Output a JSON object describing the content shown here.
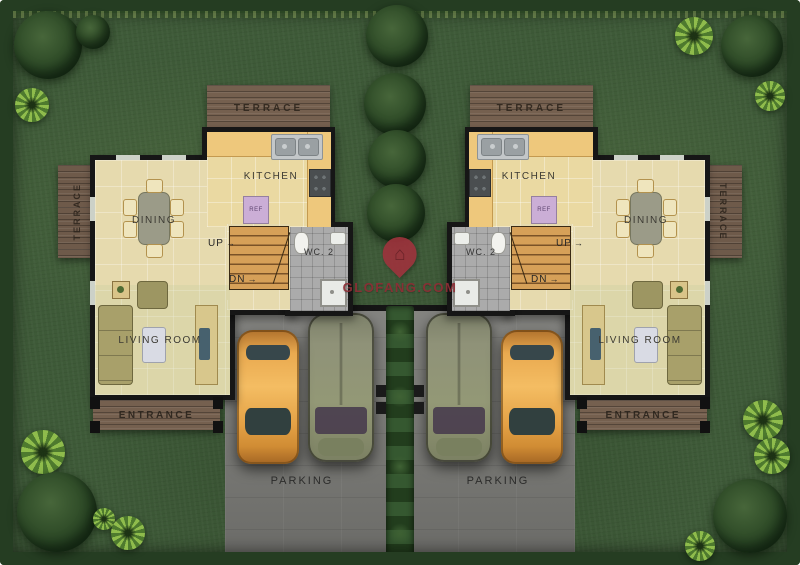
{
  "labels": {
    "terrace": "TERRACE",
    "kitchen": "KITCHEN",
    "dining": "DINING",
    "living_room": "LIVING ROOM",
    "entrance": "ENTRANCE",
    "wc": "WC. 2",
    "up": "UP",
    "dn": "DN",
    "arrow": "→",
    "ref": "REF",
    "parking": "PARKING"
  },
  "watermark": {
    "site": "GLOFANG.COM"
  },
  "colors": {
    "grass": "#3e5a38",
    "hedge": "#253d22",
    "floor": "#e6daae",
    "kitchen_counter": "#eec87c",
    "terrace_wood": "#75604f",
    "wall": "#161616",
    "wc_floor": "#ababab",
    "parking": "#7e7e7a",
    "car_orange": "#e9a94f",
    "car_gray": "#8f9278",
    "stairs": "#d6a058",
    "watermark_red": "#8e2d35"
  }
}
